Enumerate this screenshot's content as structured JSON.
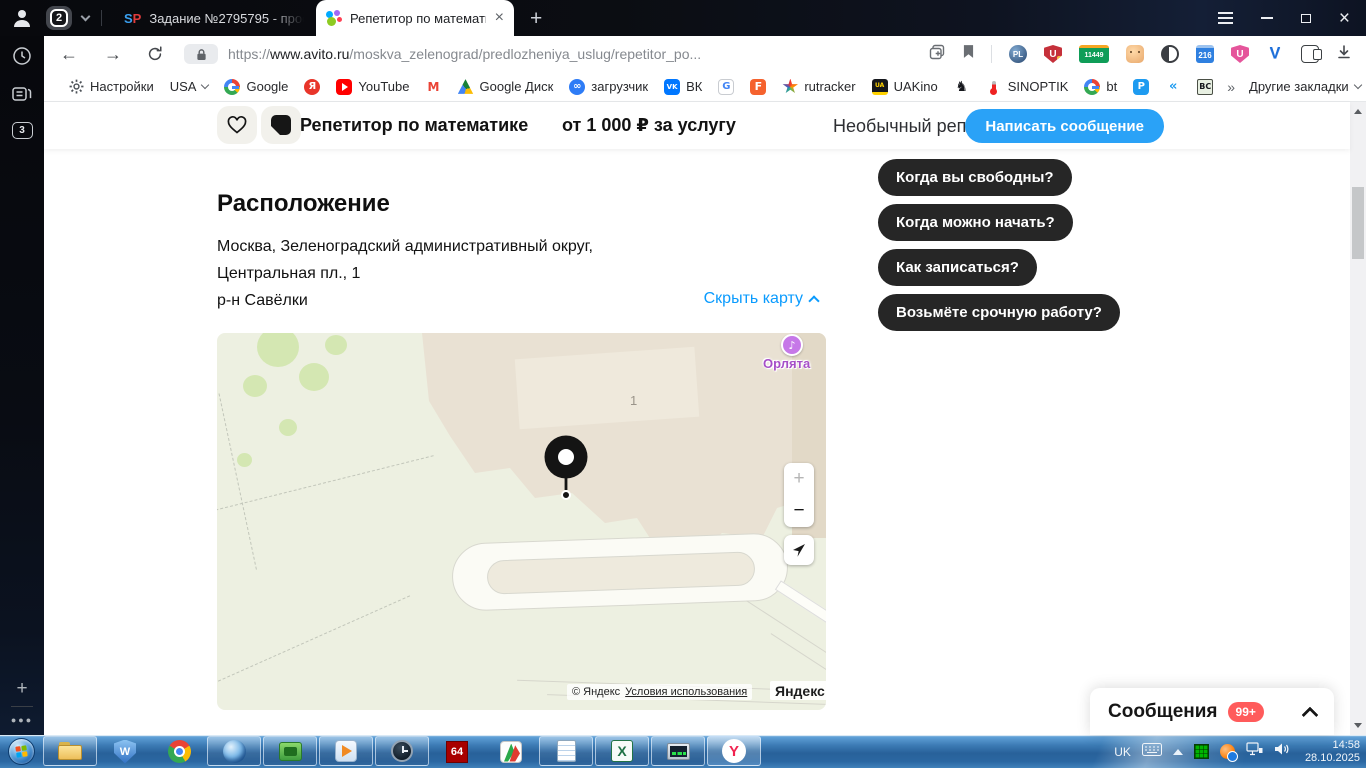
{
  "colors": {
    "accent": "#2aa2f7",
    "link": "#0a9bfe",
    "pill": "#262626",
    "badge": "#ff5b5b"
  },
  "window": {
    "tab_group_count": "2",
    "tab1_favicon_s": "S",
    "tab1_favicon_p": "P",
    "tab1_title": "Задание №2795795 - прос",
    "tab2_title": "Репетитор по математи",
    "close_glyph": "×",
    "new_tab_glyph": "+"
  },
  "sidebar": {
    "tab_stack_count": "3"
  },
  "toolbar": {
    "url_scheme": "https://",
    "url_domain": "www.avito.ru",
    "url_path": "/moskva_zelenograd/predlozheniya_uslug/repetitor_po...",
    "ext_globe_badge": "PL",
    "ext_shield_letter": "U",
    "ext_shield_alert": "!",
    "ext_counter_badge": "11449",
    "ext_calendar_badge": "216",
    "ext_pink_letter": "U",
    "ext_v_letter": "V"
  },
  "bookmarks": {
    "items": [
      {
        "label": "Настройки"
      },
      {
        "label": "USA"
      },
      {
        "icon_text": "G",
        "label": "Google"
      },
      {
        "icon_text": "Я",
        "label": ""
      },
      {
        "label": "YouTube"
      },
      {
        "icon_text": "M",
        "label": ""
      },
      {
        "label": "Google Диск"
      },
      {
        "icon_text": "∞",
        "label": "загрузчик"
      },
      {
        "icon_text": "VK",
        "label": "ВК"
      },
      {
        "icon_text": "G",
        "label": ""
      },
      {
        "icon_text": "F",
        "label": ""
      },
      {
        "label": "rutracker"
      },
      {
        "icon_text": "UA",
        "label": "UAKino"
      },
      {
        "icon_text": "♞",
        "label": ""
      },
      {
        "label": "SINOPTIK"
      },
      {
        "icon_text": "G",
        "label": "bt"
      },
      {
        "icon_text": "P",
        "label": ""
      },
      {
        "icon_text": "«",
        "label": ""
      },
      {
        "icon_text": "BC",
        "label": ""
      },
      {
        "label": "»"
      },
      {
        "label": "Другие закладки"
      }
    ]
  },
  "listing": {
    "title": "Репетитор по математике",
    "price": "от 1 000 ₽ за услугу",
    "seller_note": "Необычный репетитор",
    "message_button": "Написать сообщение"
  },
  "quick_replies": {
    "q1": "Когда вы свободны?",
    "q2": "Когда можно начать?",
    "q3": "Как записаться?",
    "q4": "Возьмёте срочную работу?"
  },
  "location": {
    "heading": "Расположение",
    "address_line1": "Москва, Зеленоградский административный округ,",
    "address_line2": "Центральная пл., 1",
    "address_line3": "р-н Савёлки",
    "toggle_map_label": "Скрыть карту"
  },
  "map": {
    "poi_glyph": "♪",
    "poi_label": "Орлята",
    "building_number": "1",
    "zoom_in": "+",
    "zoom_out": "−",
    "copyright": "© Яндекс",
    "terms_link": "Условия использования",
    "brand": "Яндекс"
  },
  "messages": {
    "label": "Сообщения",
    "badge": "99+"
  },
  "taskbar": {
    "aida_label": "64",
    "wondershare_letter": "W",
    "excel_letter": "X",
    "yandex_letter": "Y",
    "tray": {
      "lang": "UK",
      "time": "14:58",
      "date": "28.10.2025"
    }
  }
}
